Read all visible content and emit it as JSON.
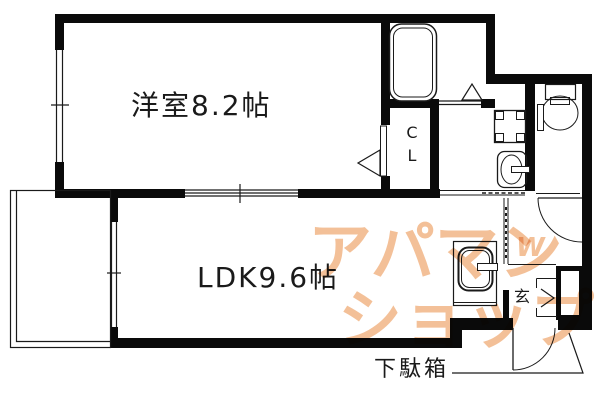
{
  "rooms": {
    "western_room_label": "洋室8.2帖",
    "ldk_label": "LDK9.6帖",
    "closet_letter_top": "C",
    "closet_letter_bottom": "L",
    "entrance_label": "玄",
    "shoe_cabinet_label": "下駄箱"
  },
  "fixtures": {
    "bathtub": "bathtub-icon",
    "toilet": "toilet-icon",
    "wash_basin": "wash-basin-icon",
    "washer_pan": "washing-machine-pan-icon",
    "kitchen_sink": "kitchen-sink-icon",
    "balcony": "balcony-rail",
    "doors": "door-swing-arcs",
    "windows": "double-line-windows"
  },
  "watermark": {
    "line1": "アパマン",
    "line2": "ショップ",
    "monogram": "W",
    "color": "#f3bd92"
  },
  "colors": {
    "wall": "#0a0a0a",
    "line": "#1a1a1a",
    "background": "#ffffff"
  }
}
